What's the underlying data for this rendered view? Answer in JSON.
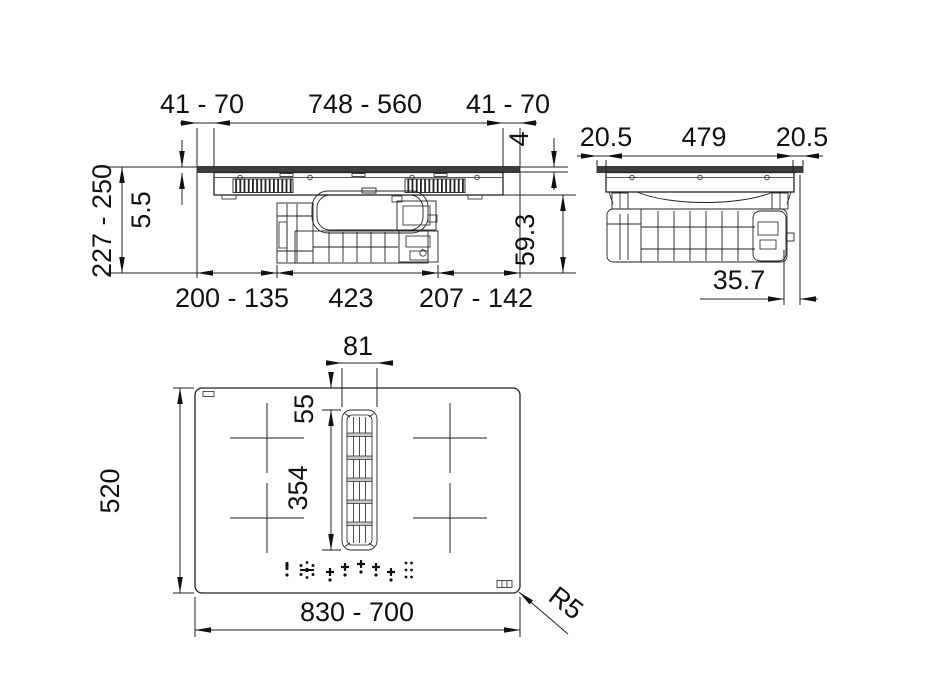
{
  "front_view": {
    "label": "front-section-view",
    "dims": {
      "overhang_left": "41 - 70",
      "cutout_width": "748 - 560",
      "overhang_right": "41 - 70",
      "glass_thickness": "4",
      "install_height": "227 - 250",
      "top_profile_height": "5.5",
      "under_glass_height": "59.3",
      "offset_left": "200 - 135",
      "motor_width": "423",
      "offset_right": "207 - 142"
    }
  },
  "side_view": {
    "label": "side-section-view",
    "dims": {
      "overhang_front": "20.5",
      "cutout_depth": "479",
      "overhang_rear": "20.5",
      "rear_clearance": "35.7"
    }
  },
  "plan_view": {
    "label": "top-plan-view",
    "dims": {
      "grille_width": "81",
      "grille_offset_top": "55",
      "grille_length": "354",
      "hob_depth": "520",
      "hob_width": "830 - 700",
      "corner_radius": "R5"
    }
  },
  "colors": {
    "line": "#222222",
    "glass_fill": "#3d3d3d",
    "crossbar_fill": "#c8c8c8",
    "background": "#ffffff"
  }
}
